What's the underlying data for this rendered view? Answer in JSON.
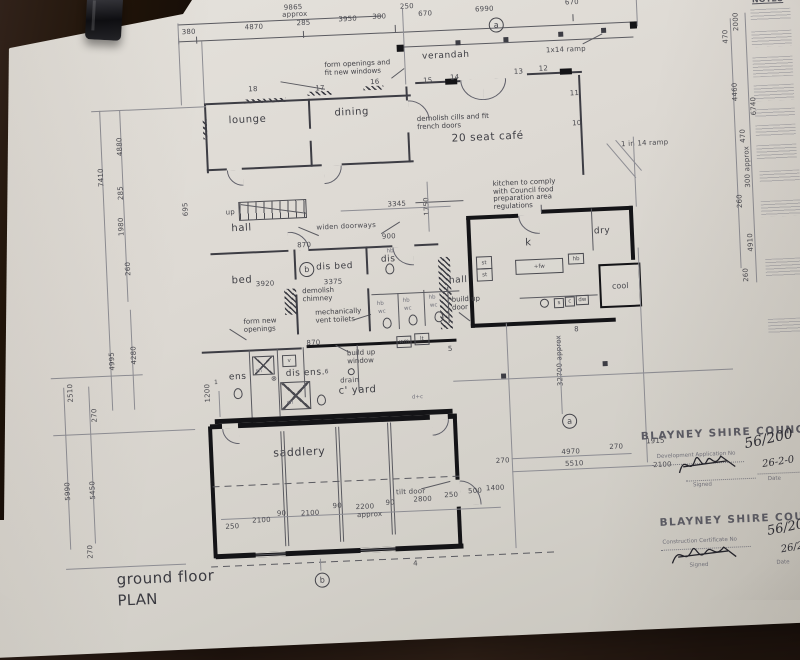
{
  "photo": {
    "surface": "dark wood table",
    "clip": "black binder clip"
  },
  "title": {
    "line1": "ground floor",
    "line2": "PLAN"
  },
  "notes_panel": {
    "heading": "NOTES"
  },
  "markers": {
    "a": "a",
    "b": "b"
  },
  "rooms": {
    "lounge": "lounge",
    "dining": "dining",
    "verandah": "verandah",
    "cafe": "20 seat café",
    "hall_front": "hall",
    "bed": "bed",
    "dis_bed": "dis bed",
    "dis_wc": "dis",
    "kitchen": "k",
    "dry": "dry",
    "cool": "cool",
    "hall_rear": "hall",
    "ens": "ens",
    "dis_ens": "dis ens.",
    "courtyard": "c' yard",
    "saddlery": "saddlery"
  },
  "annotations": {
    "form_openings": "form openings and fit new windows",
    "demolish_cills": "demolish cills and fit french doors",
    "ramp_top": "1x14 ramp",
    "ramp_right": "1 in 14 ramp",
    "kitchen_note": "kitchen to comply with Council food preparation area regulations",
    "widen_doorways": "widen doorways",
    "demolish_chimney": "demolish chimney",
    "mech_vent": "mechanically vent toilets",
    "form_new_openings": "form new openings",
    "build_up_door": "build up door",
    "build_up_window": "build up window",
    "tilt_door": "tilt door",
    "drain": "drain",
    "up": "up"
  },
  "fixtures": {
    "wm": "wm",
    "lt": "lt",
    "hb": "hb",
    "wc": "wc",
    "sh": "sh",
    "st": "st",
    "s": "s",
    "c": "c",
    "dw": "dw",
    "fw": "+fw",
    "v": "v",
    "dc": "d+c"
  },
  "window_numbers": {
    "n1": "1",
    "n4": "4",
    "n5": "5",
    "n6": "6",
    "n8": "8",
    "n10": "10",
    "n11": "11",
    "n12": "12",
    "n13": "13",
    "n14": "14",
    "n15": "15",
    "n16": "16",
    "n17": "17",
    "n18": "18"
  },
  "dimensions": {
    "top_overall": "9865",
    "top_overall_suffix": "approx",
    "top_row": [
      "380",
      "4870",
      "285",
      "3950",
      "380"
    ],
    "verandah_row": [
      "250",
      "670",
      "6990",
      "670"
    ],
    "left_col": [
      "7410",
      "4880",
      "285",
      "1980",
      "260",
      "4995",
      "4280",
      "2510",
      "270",
      "5990",
      "5450",
      "270"
    ],
    "right_col": [
      "2000",
      "470",
      "4460",
      "6740",
      "470",
      "300 approx",
      "260",
      "4910",
      "260"
    ],
    "interior": {
      "d3345": "3345",
      "d1750": "1750",
      "d870a": "870",
      "d900": "900",
      "d695": "695",
      "d3920": "3920",
      "d3375": "3375",
      "d870b": "870",
      "d1200": "1200"
    },
    "saddlery_row": [
      "250",
      "2100",
      "90",
      "2100",
      "90",
      "2200",
      "90",
      "2800",
      "250",
      "500",
      "1400"
    ],
    "saddlery_row_suffix": "approx",
    "site": {
      "d5510": "5510",
      "d4970": "4970",
      "d270a": "270",
      "d270b": "270",
      "d1915": "1915",
      "d2100": "2100",
      "d32700": "32700 approx"
    }
  },
  "stamps": {
    "development": {
      "org": "BLAYNEY SHIRE COUNCIL",
      "field": "Development Application No",
      "number": "56/200",
      "date": "26-2-0",
      "signed_label": "Signed",
      "date_label": "Date"
    },
    "construction": {
      "org": "BLAYNEY SHIRE COUNCIL",
      "field": "Construction Certificate No",
      "number": "56/20",
      "date": "26/2/",
      "signed_label": "Signed",
      "date_label": "Date"
    }
  }
}
